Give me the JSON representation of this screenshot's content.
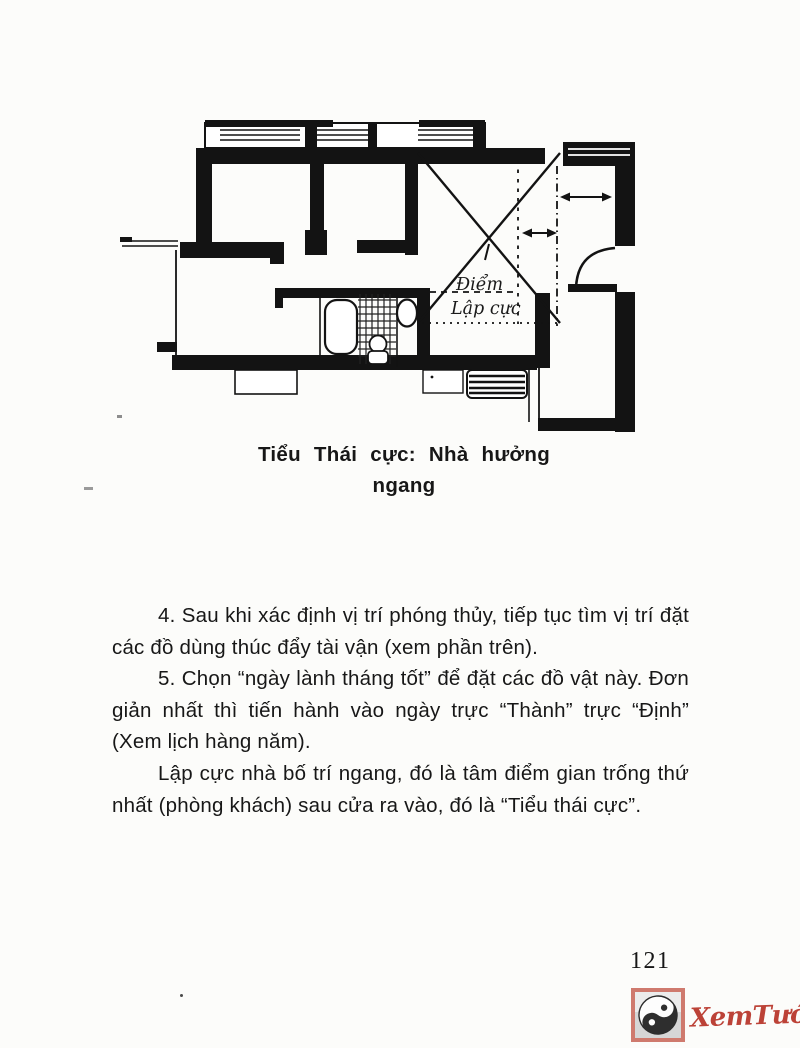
{
  "document": {
    "figure": {
      "type": "floor-plan",
      "label": {
        "line1": "Điểm",
        "line2": "Lập cực"
      }
    },
    "caption": {
      "line1": "Tiểu Thái cực: Nhà hưởng",
      "line2": "ngang"
    },
    "paragraphs": [
      "4. Sau khi xác định vị trí phóng thủy, tiếp tục tìm vị trí đặt các đồ dùng thúc đẩy tài vận (xem phần trên).",
      "5. Chọn “ngày lành tháng tốt” để đặt các đồ vật này. Đơn giản nhất thì tiến hành vào ngày trực “Thành” trực “Định” (Xem lịch hàng năm).",
      "Lập cực nhà bố trí ngang, đó là tâm điểm gian trống thứ nhất (phòng khách) sau cửa ra vào, đó là “Tiểu thái cực”."
    ],
    "page_number": "121",
    "watermark": {
      "text": "XemTướng.net",
      "accent_color": "#bc4237",
      "icon_border_color": "#cf7a6e"
    }
  }
}
